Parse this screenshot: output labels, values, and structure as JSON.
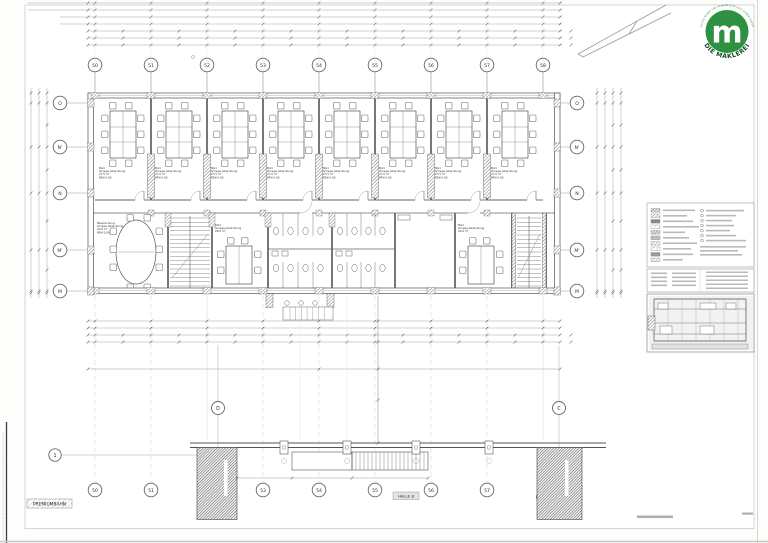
{
  "logo": {
    "letter": "m",
    "arc_text": "ALLES RUND UM IMMOBILIEN AUS EINER HAND",
    "wordmark": "DIE MAKLEREI",
    "green": "#2e9041",
    "dark_green": "#0f4d20"
  },
  "grid": {
    "top": [
      "50",
      "51",
      "52",
      "53",
      "54",
      "55",
      "56",
      "57",
      "58"
    ],
    "bottom": [
      "50",
      "51",
      "52",
      "53",
      "54",
      "55",
      "56",
      "57",
      "58"
    ],
    "left": [
      "O",
      "N'",
      "N",
      "M'",
      "M"
    ],
    "right": [
      "O",
      "N'",
      "N",
      "M'",
      "M"
    ],
    "hall_left": "D",
    "hall_right": "C",
    "row_axis": "1"
  },
  "labels": {
    "halle": "HALLE B",
    "site": "PREMIUMBAHN"
  },
  "rooms": {
    "office": {
      "l1": "Büro",
      "l2": "Gruppe Abwicklung",
      "l3": "27,5 m²",
      "l4": "BRH 0,90"
    },
    "conference": {
      "l1": "Besprechung",
      "l2": "Gruppe Abwicklung",
      "l3": "41,8 m²",
      "l4": "BRH 0,90"
    },
    "meeting1": {
      "l1": "Büro",
      "l2": "Gruppe Abwicklung",
      "l3": "26,4 m²"
    },
    "meeting2": {
      "l1": "Büro",
      "l2": "Gruppe Abwicklung",
      "l3": "26,4 m²"
    }
  }
}
